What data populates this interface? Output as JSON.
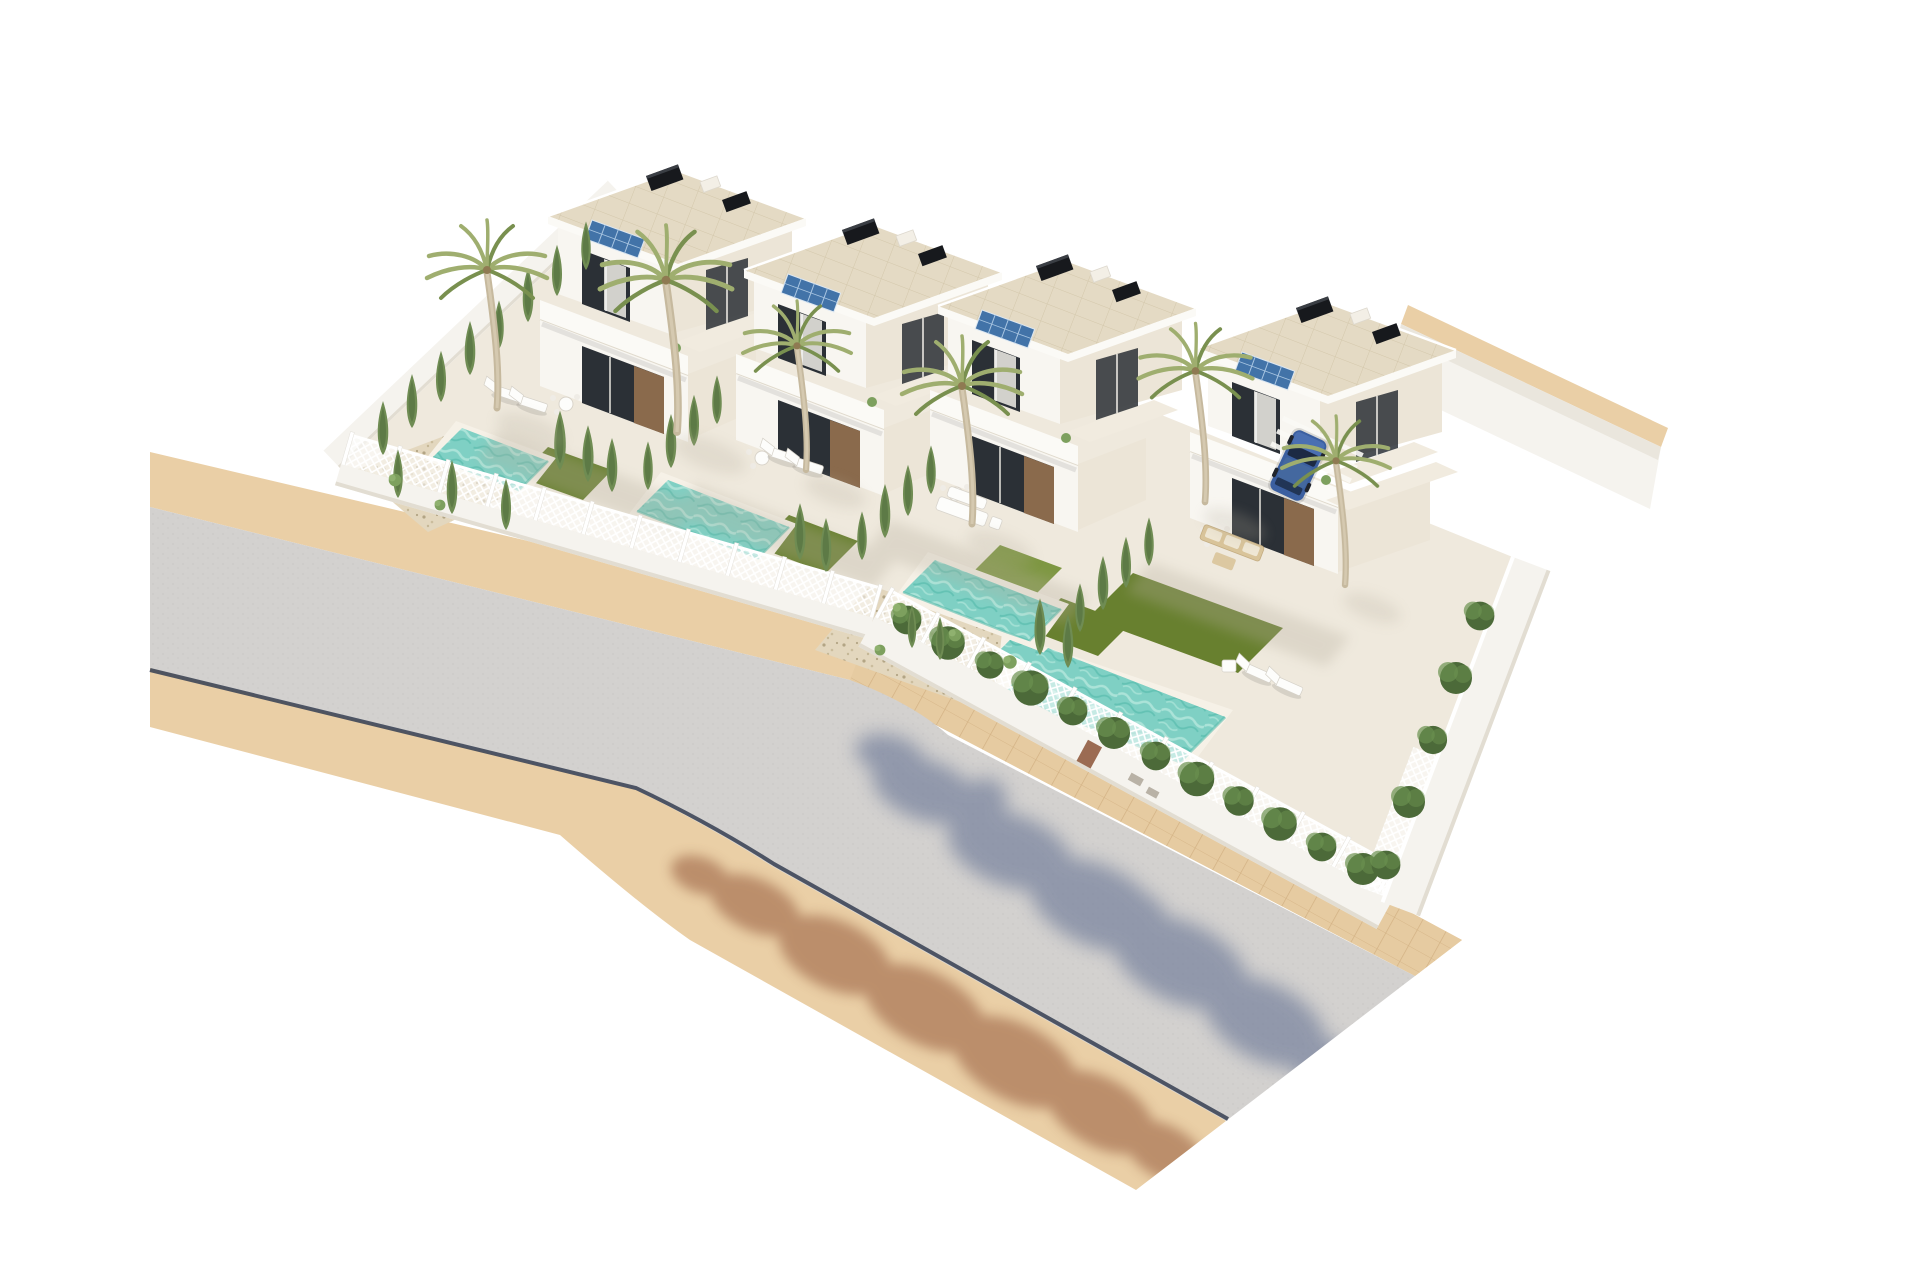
{
  "scene": {
    "type": "3d-architectural-render",
    "subject": "aerial-view-of-four-white-villas-with-private-pools-beside-curved-road",
    "villa_count": 4,
    "pool_count": 4,
    "palm_tree_count": 6,
    "solar_panel_count": 4,
    "car_count": 1,
    "has_visible_text": false,
    "road": {
      "segments": 2,
      "sidewalks": true,
      "paver_walkway": true,
      "curb_line": true,
      "tree_shadows": true
    },
    "landscaping": [
      "cypress-trees",
      "palm-trees",
      "hedges",
      "lawns",
      "gravel-beds",
      "shrubs"
    ],
    "furniture": [
      "sun-loungers",
      "white-garden-sofa",
      "rattan-sofa",
      "terrace-tables"
    ]
  },
  "colors": {
    "background": "#ffffff",
    "asphalt": "#d3d1cf",
    "asphalt_speckle": "#c7c5c3",
    "curb": "#3e4658",
    "sidewalk": "#eacfa6",
    "paver": "#e6cba1",
    "paver_joint": "#d2b183",
    "plot_ground": "#efe9dd",
    "wall_white": "#f5f3ee",
    "wall_shade": "#e2ddd2",
    "fence_white": "#ffffff",
    "roof_deck": "#e4dac4",
    "roof_joint": "#d3c7ab",
    "roof_fascia": "#fbfaf6",
    "facade_white": "#f8f6f1",
    "facade_shade": "#ece5d7",
    "glass_dark": "#2b3036",
    "curtain": "#f0ede6",
    "wood": "#8a6a4c",
    "rooftop_unit": "#17191d",
    "solar": "#4273a8",
    "solar_grid": "#a9c6e2",
    "pool_water": "#7fd0c4",
    "pool_wave_light": "#abe3d8",
    "pool_wave_dark": "#58bcae",
    "pool_coping": "#f6f1e7",
    "lawn": "#68802f",
    "lawn_light": "#7e9742",
    "gravel": "#e3d7be",
    "gravel_dot": "#b3a585",
    "cypress": "#6f8c53",
    "cypress_dark": "#4f6c3c",
    "palm_frond": "#9fae6f",
    "palm_frond_dark": "#79904f",
    "palm_trunk": "#c6b99e",
    "hedge": "#4c6a39",
    "hedge_light": "#6b9150",
    "shrub": "#7da05e",
    "furniture_white": "#fdfdfb",
    "furniture_rattan": "#d9c49a",
    "car_body": "#3b5fa0",
    "car_body_light": "#4a6fb2",
    "car_glass": "#1c2a44",
    "door_brown": "#9b6b52",
    "shadow_cool": "#5c6a8e",
    "shadow_warm": "#9c6444",
    "building_shadow": "#b5ad9c"
  }
}
